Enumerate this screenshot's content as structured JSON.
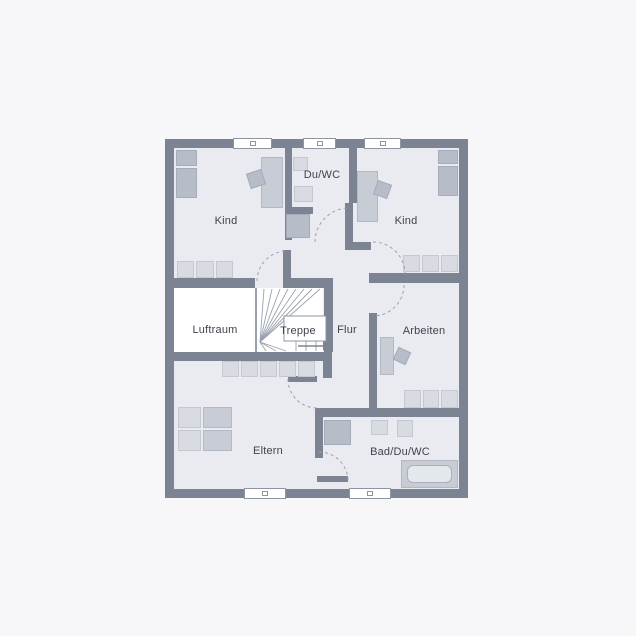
{
  "plan": {
    "type": "floor-plan",
    "language": "de",
    "rooms": {
      "kind_left": {
        "label": "Kind"
      },
      "du_wc": {
        "label": "Du/WC"
      },
      "kind_right": {
        "label": "Kind"
      },
      "luftraum": {
        "label": "Luftraum"
      },
      "treppe": {
        "label": "Treppe"
      },
      "flur": {
        "label": "Flur"
      },
      "arbeiten": {
        "label": "Arbeiten"
      },
      "eltern": {
        "label": "Eltern"
      },
      "bad": {
        "label": "Bad/Du/WC"
      }
    },
    "icons": {
      "stairs_direction_arrow": "right",
      "door_swings": 6,
      "windows_top": 3,
      "windows_bottom": 2
    },
    "colors": {
      "wall": "#7c8494",
      "floor": "#e9ebf0",
      "void": "#ffffff",
      "furniture": "#c7ccd5",
      "furniture_dark": "#b6bcc8",
      "furniture_light": "#d8dbe2",
      "text": "#3e434e",
      "background": "#f7f7f9",
      "hairline": "#9aa1ae"
    }
  }
}
